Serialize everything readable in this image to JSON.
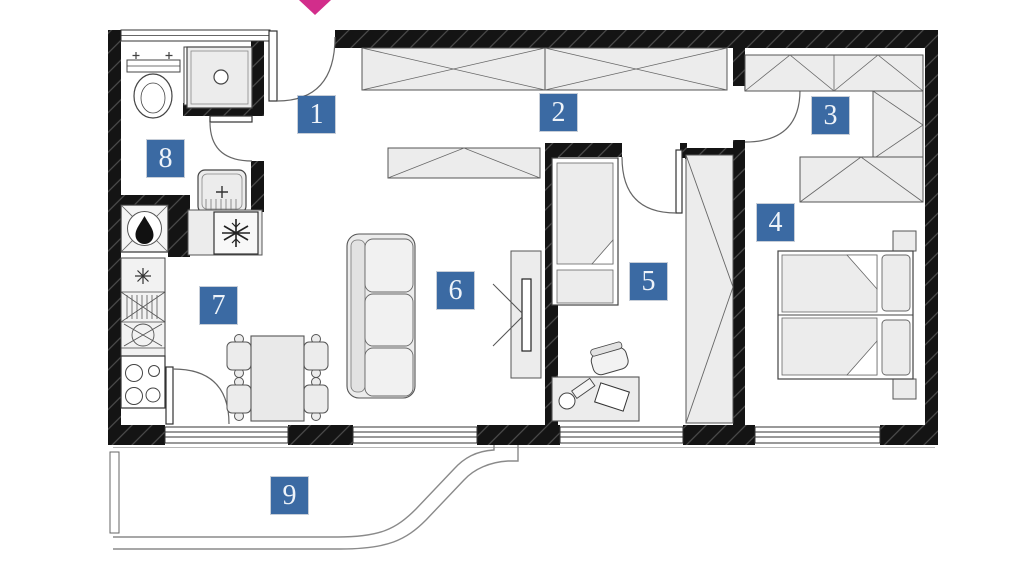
{
  "plan": {
    "title": "apartment floor plan",
    "rooms": [
      {
        "label": "1",
        "name": "entry-hall"
      },
      {
        "label": "2",
        "name": "hallway"
      },
      {
        "label": "3",
        "name": "wardrobe-area"
      },
      {
        "label": "4",
        "name": "bedroom"
      },
      {
        "label": "5",
        "name": "kids-room"
      },
      {
        "label": "6",
        "name": "living-room"
      },
      {
        "label": "7",
        "name": "kitchen-dining"
      },
      {
        "label": "8",
        "name": "bathroom"
      },
      {
        "label": "9",
        "name": "terrace"
      }
    ],
    "colors": {
      "wall": "#141414",
      "furniture_fill": "#ececec",
      "furniture_stroke": "#555555",
      "label_background": "#3b6aa3",
      "label_text": "#eef3f9",
      "entrance_arrow": "#d22d8b"
    },
    "icons": [
      "entrance-arrow-icon",
      "toilet-icon",
      "shower-icon",
      "washbasin-icon",
      "boiler-flame-icon",
      "fridge-snowflake-icon",
      "stove-burners-icon",
      "sink-icon"
    ]
  }
}
